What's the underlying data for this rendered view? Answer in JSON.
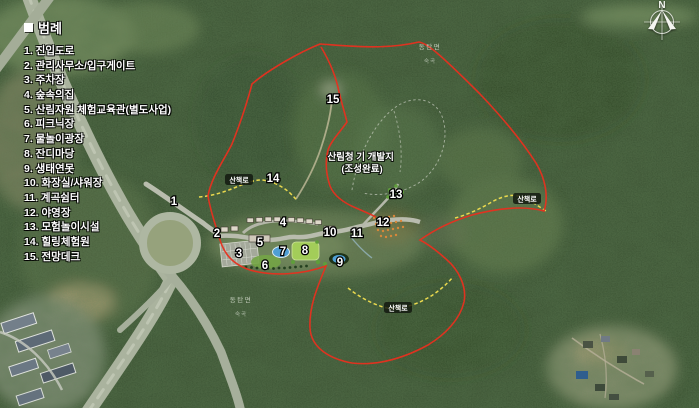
{
  "legend": {
    "bullet": "■",
    "title": "범례",
    "items": [
      {
        "num": "1",
        "label": "진입도로"
      },
      {
        "num": "2",
        "label": "관리사무소/입구게이트"
      },
      {
        "num": "3",
        "label": "주차장"
      },
      {
        "num": "4",
        "label": "숲속의집"
      },
      {
        "num": "5",
        "label": "산림자원 체험교육관(별도사업)"
      },
      {
        "num": "6",
        "label": "피크닉장"
      },
      {
        "num": "7",
        "label": "물놀이광장"
      },
      {
        "num": "8",
        "label": "잔디마당"
      },
      {
        "num": "9",
        "label": "생태연못"
      },
      {
        "num": "10",
        "label": "화장실/샤워장"
      },
      {
        "num": "11",
        "label": "계곡쉼터"
      },
      {
        "num": "12",
        "label": "야영장"
      },
      {
        "num": "13",
        "label": "모험놀이시설"
      },
      {
        "num": "14",
        "label": "힐링체험원"
      },
      {
        "num": "15",
        "label": "전망데크"
      }
    ]
  },
  "markers": [
    {
      "num": "1",
      "x": 174,
      "y": 201
    },
    {
      "num": "2",
      "x": 217,
      "y": 233
    },
    {
      "num": "3",
      "x": 239,
      "y": 253
    },
    {
      "num": "4",
      "x": 283,
      "y": 222
    },
    {
      "num": "5",
      "x": 260,
      "y": 242
    },
    {
      "num": "6",
      "x": 265,
      "y": 265
    },
    {
      "num": "7",
      "x": 283,
      "y": 251
    },
    {
      "num": "8",
      "x": 305,
      "y": 250
    },
    {
      "num": "9",
      "x": 340,
      "y": 262
    },
    {
      "num": "10",
      "x": 330,
      "y": 232
    },
    {
      "num": "11",
      "x": 357,
      "y": 233
    },
    {
      "num": "12",
      "x": 383,
      "y": 222
    },
    {
      "num": "13",
      "x": 396,
      "y": 194
    },
    {
      "num": "14",
      "x": 273,
      "y": 178
    },
    {
      "num": "15",
      "x": 333,
      "y": 99
    }
  ],
  "map_labels": {
    "developed_site": {
      "line1": "산림청 기 개발지",
      "line2": "(조성완료)"
    },
    "trail_badges": {
      "text": "산책로",
      "positions": [
        {
          "x": 239,
          "y": 180
        },
        {
          "x": 527,
          "y": 199
        },
        {
          "x": 398,
          "y": 308
        }
      ]
    },
    "place_names": [
      {
        "text": "동탄면",
        "sub": "숙곡",
        "x": 430,
        "y": 47,
        "sy": 61
      },
      {
        "text": "동탄면",
        "sub": "숙곡",
        "x": 241,
        "y": 300,
        "sy": 314
      }
    ]
  },
  "compass": {
    "north_label": "N"
  },
  "colors": {
    "boundary": "#e8301f",
    "trail": "#ead94e",
    "water": "#4f9fd4",
    "lawn": "#a3cd59"
  }
}
